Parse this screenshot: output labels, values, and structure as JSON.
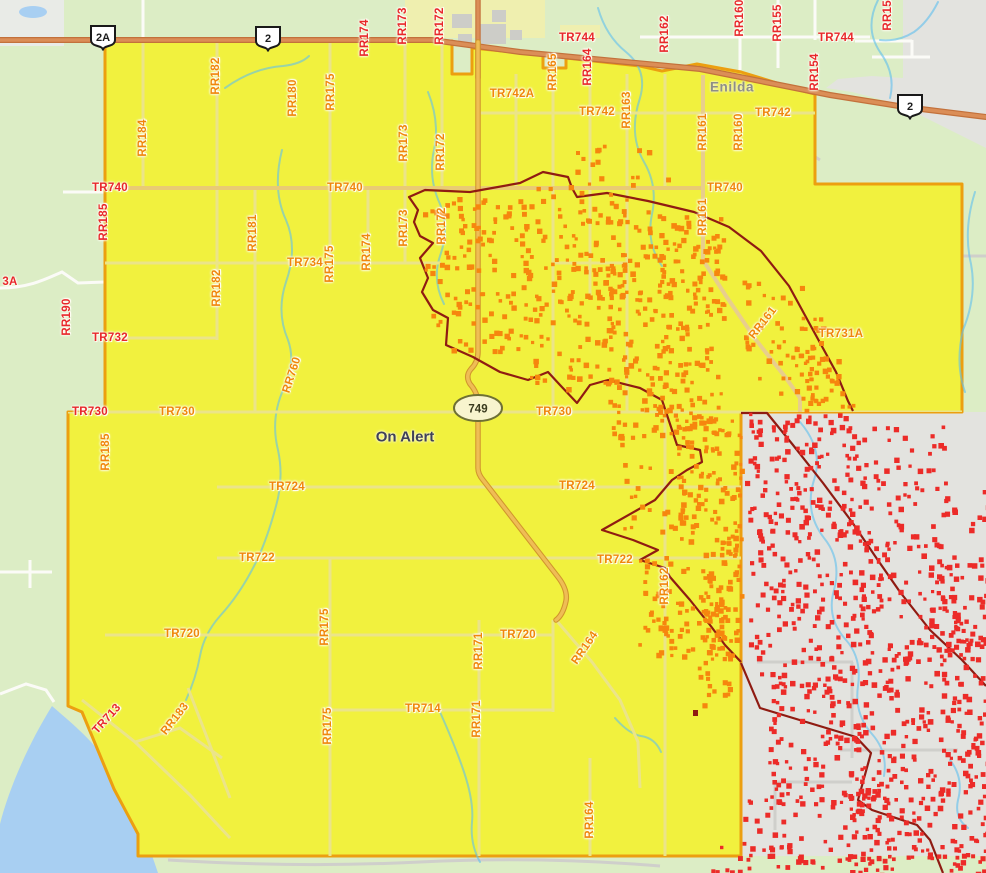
{
  "map": {
    "region_status_label": "On Alert",
    "town_label": "Enilda",
    "colors": {
      "alert_zone_fill": "#F1F13E",
      "alert_zone_border": "#EC9F10",
      "orange_hotspot": "#F6860E",
      "red_hotspot": "#EC2B28",
      "hotspot_boundary": "#8F1B12",
      "highway_fill": "#DB8E57",
      "label_red": "#E8272B",
      "label_orange": "#F0860B",
      "water": "#A8CFF2",
      "rural_land": "#DCEDC5",
      "urban_land": "#E3E3DF"
    },
    "highway_shields": [
      {
        "label": "2A",
        "x": 103,
        "y": 37,
        "kind": "provincial"
      },
      {
        "label": "2",
        "x": 268,
        "y": 38,
        "kind": "provincial"
      },
      {
        "label": "2",
        "x": 910,
        "y": 106,
        "kind": "provincial"
      },
      {
        "label": "749",
        "x": 478,
        "y": 408,
        "kind": "secondary-oval"
      }
    ],
    "road_labels": [
      {
        "t": "RR174",
        "x": 365,
        "y": 38,
        "r": -90,
        "c": "red"
      },
      {
        "t": "RR173",
        "x": 403,
        "y": 26,
        "r": -90,
        "c": "red"
      },
      {
        "t": "RR172",
        "x": 440,
        "y": 26,
        "r": -90,
        "c": "red"
      },
      {
        "t": "TR744",
        "x": 577,
        "y": 38,
        "r": 0,
        "c": "red"
      },
      {
        "t": "RR164",
        "x": 588,
        "y": 67,
        "r": -90,
        "c": "red"
      },
      {
        "t": "RR162",
        "x": 665,
        "y": 34,
        "r": -90,
        "c": "red"
      },
      {
        "t": "RR160",
        "x": 740,
        "y": 18,
        "r": -90,
        "c": "red"
      },
      {
        "t": "RR155",
        "x": 778,
        "y": 23,
        "r": -90,
        "c": "red"
      },
      {
        "t": "TR744",
        "x": 836,
        "y": 38,
        "r": 0,
        "c": "red"
      },
      {
        "t": "RR154",
        "x": 815,
        "y": 72,
        "r": -90,
        "c": "red"
      },
      {
        "t": "RR153",
        "x": 888,
        "y": 12,
        "r": -90,
        "c": "red"
      },
      {
        "t": "RR185",
        "x": 104,
        "y": 222,
        "r": -90,
        "c": "red"
      },
      {
        "t": "TR740",
        "x": 110,
        "y": 188,
        "r": 0,
        "c": "red"
      },
      {
        "t": "RR190",
        "x": 67,
        "y": 317,
        "r": -90,
        "c": "red"
      },
      {
        "t": "3A",
        "x": 10,
        "y": 282,
        "r": 0,
        "c": "red"
      },
      {
        "t": "TR732",
        "x": 110,
        "y": 338,
        "r": 0,
        "c": "red"
      },
      {
        "t": "TR730",
        "x": 90,
        "y": 412,
        "r": 0,
        "c": "red"
      },
      {
        "t": "TR713",
        "x": 107,
        "y": 719,
        "r": -48,
        "c": "red"
      },
      {
        "t": "RR184",
        "x": 143,
        "y": 138,
        "r": -90,
        "c": "org"
      },
      {
        "t": "RR182",
        "x": 216,
        "y": 76,
        "r": -90,
        "c": "org"
      },
      {
        "t": "RR180",
        "x": 293,
        "y": 98,
        "r": -90,
        "c": "org"
      },
      {
        "t": "RR175",
        "x": 331,
        "y": 92,
        "r": -90,
        "c": "org"
      },
      {
        "t": "RR173",
        "x": 404,
        "y": 143,
        "r": -90,
        "c": "org"
      },
      {
        "t": "RR172",
        "x": 441,
        "y": 152,
        "r": -90,
        "c": "org"
      },
      {
        "t": "TR742A",
        "x": 512,
        "y": 94,
        "r": 0,
        "c": "org"
      },
      {
        "t": "RR165",
        "x": 553,
        "y": 72,
        "r": -90,
        "c": "org"
      },
      {
        "t": "TR742",
        "x": 597,
        "y": 112,
        "r": 0,
        "c": "org"
      },
      {
        "t": "RR163",
        "x": 627,
        "y": 110,
        "r": -90,
        "c": "org"
      },
      {
        "t": "RR161",
        "x": 703,
        "y": 132,
        "r": -90,
        "c": "org"
      },
      {
        "t": "RR160",
        "x": 739,
        "y": 132,
        "r": -90,
        "c": "org"
      },
      {
        "t": "TR742",
        "x": 773,
        "y": 113,
        "r": 0,
        "c": "org"
      },
      {
        "t": "RR181",
        "x": 253,
        "y": 233,
        "r": -90,
        "c": "org"
      },
      {
        "t": "TR734",
        "x": 305,
        "y": 263,
        "r": 0,
        "c": "org"
      },
      {
        "t": "RR175",
        "x": 330,
        "y": 264,
        "r": -90,
        "c": "org"
      },
      {
        "t": "RR182",
        "x": 217,
        "y": 288,
        "r": -90,
        "c": "org"
      },
      {
        "t": "RR174",
        "x": 367,
        "y": 252,
        "r": -90,
        "c": "org"
      },
      {
        "t": "RR173",
        "x": 404,
        "y": 228,
        "r": -90,
        "c": "org"
      },
      {
        "t": "RR172",
        "x": 442,
        "y": 226,
        "r": -90,
        "c": "org"
      },
      {
        "t": "TR740",
        "x": 345,
        "y": 188,
        "r": 0,
        "c": "org"
      },
      {
        "t": "TR740",
        "x": 725,
        "y": 188,
        "r": 0,
        "c": "org"
      },
      {
        "t": "RR161",
        "x": 703,
        "y": 217,
        "r": -90,
        "c": "org"
      },
      {
        "t": "RR161",
        "x": 763,
        "y": 323,
        "r": -52,
        "c": "org"
      },
      {
        "t": "TR731A",
        "x": 841,
        "y": 334,
        "r": 0,
        "c": "org"
      },
      {
        "t": "RR760",
        "x": 292,
        "y": 375,
        "r": -72,
        "c": "org"
      },
      {
        "t": "RR185",
        "x": 106,
        "y": 452,
        "r": -90,
        "c": "org"
      },
      {
        "t": "TR730",
        "x": 177,
        "y": 412,
        "r": 0,
        "c": "org"
      },
      {
        "t": "TR730",
        "x": 554,
        "y": 412,
        "r": 0,
        "c": "org"
      },
      {
        "t": "TR724",
        "x": 577,
        "y": 486,
        "r": 0,
        "c": "org"
      },
      {
        "t": "TR724",
        "x": 287,
        "y": 487,
        "r": 0,
        "c": "org"
      },
      {
        "t": "TR722",
        "x": 615,
        "y": 560,
        "r": 0,
        "c": "org"
      },
      {
        "t": "TR722",
        "x": 257,
        "y": 558,
        "r": 0,
        "c": "org"
      },
      {
        "t": "RR162",
        "x": 665,
        "y": 586,
        "r": -90,
        "c": "org"
      },
      {
        "t": "TR720",
        "x": 518,
        "y": 635,
        "r": 0,
        "c": "org"
      },
      {
        "t": "TR720",
        "x": 182,
        "y": 634,
        "r": 0,
        "c": "org"
      },
      {
        "t": "RR164",
        "x": 585,
        "y": 648,
        "r": -55,
        "c": "org"
      },
      {
        "t": "RR175",
        "x": 325,
        "y": 627,
        "r": -90,
        "c": "org"
      },
      {
        "t": "RR171",
        "x": 479,
        "y": 651,
        "r": -90,
        "c": "org"
      },
      {
        "t": "RR183",
        "x": 175,
        "y": 719,
        "r": -52,
        "c": "org"
      },
      {
        "t": "RR175",
        "x": 328,
        "y": 726,
        "r": -90,
        "c": "org"
      },
      {
        "t": "TR714",
        "x": 423,
        "y": 709,
        "r": 0,
        "c": "org"
      },
      {
        "t": "RR171",
        "x": 477,
        "y": 719,
        "r": -90,
        "c": "org"
      },
      {
        "t": "RR164",
        "x": 590,
        "y": 820,
        "r": -90,
        "c": "org"
      }
    ],
    "hotspot_clusters": [
      {
        "name": "orange-hotspots",
        "color": "#F6860E",
        "seed": 7,
        "rects": [
          [
            420,
            200,
            75,
            70,
            30
          ],
          [
            430,
            255,
            95,
            95,
            55
          ],
          [
            455,
            195,
            75,
            60,
            30
          ],
          [
            520,
            182,
            95,
            115,
            75
          ],
          [
            528,
            290,
            85,
            110,
            60
          ],
          [
            600,
            198,
            65,
            125,
            75
          ],
          [
            608,
            318,
            75,
            120,
            65
          ],
          [
            658,
            215,
            65,
            205,
            130
          ],
          [
            678,
            415,
            62,
            125,
            105
          ],
          [
            698,
            535,
            42,
            125,
            75
          ],
          [
            618,
            425,
            62,
            105,
            28
          ],
          [
            638,
            555,
            85,
            105,
            45
          ],
          [
            742,
            278,
            62,
            105,
            32
          ],
          [
            768,
            315,
            72,
            95,
            38
          ],
          [
            798,
            355,
            55,
            58,
            22
          ],
          [
            560,
            140,
            130,
            48,
            16
          ],
          [
            652,
            595,
            75,
            62,
            32
          ],
          [
            688,
            660,
            50,
            45,
            14
          ]
        ]
      },
      {
        "name": "red-hotspots",
        "color": "#EC2B28",
        "seed": 13,
        "rects": [
          [
            745,
            412,
            112,
            122,
            135
          ],
          [
            748,
            528,
            135,
            155,
            165
          ],
          [
            858,
            475,
            128,
            185,
            125
          ],
          [
            768,
            678,
            125,
            125,
            135
          ],
          [
            888,
            638,
            98,
            135,
            115
          ],
          [
            848,
            768,
            138,
            90,
            120
          ],
          [
            742,
            798,
            112,
            70,
            42
          ],
          [
            928,
            555,
            58,
            95,
            45
          ],
          [
            845,
            852,
            141,
            21,
            35
          ],
          [
            700,
            843,
            150,
            28,
            22
          ],
          [
            845,
            425,
            105,
            58,
            28
          ]
        ]
      }
    ]
  }
}
